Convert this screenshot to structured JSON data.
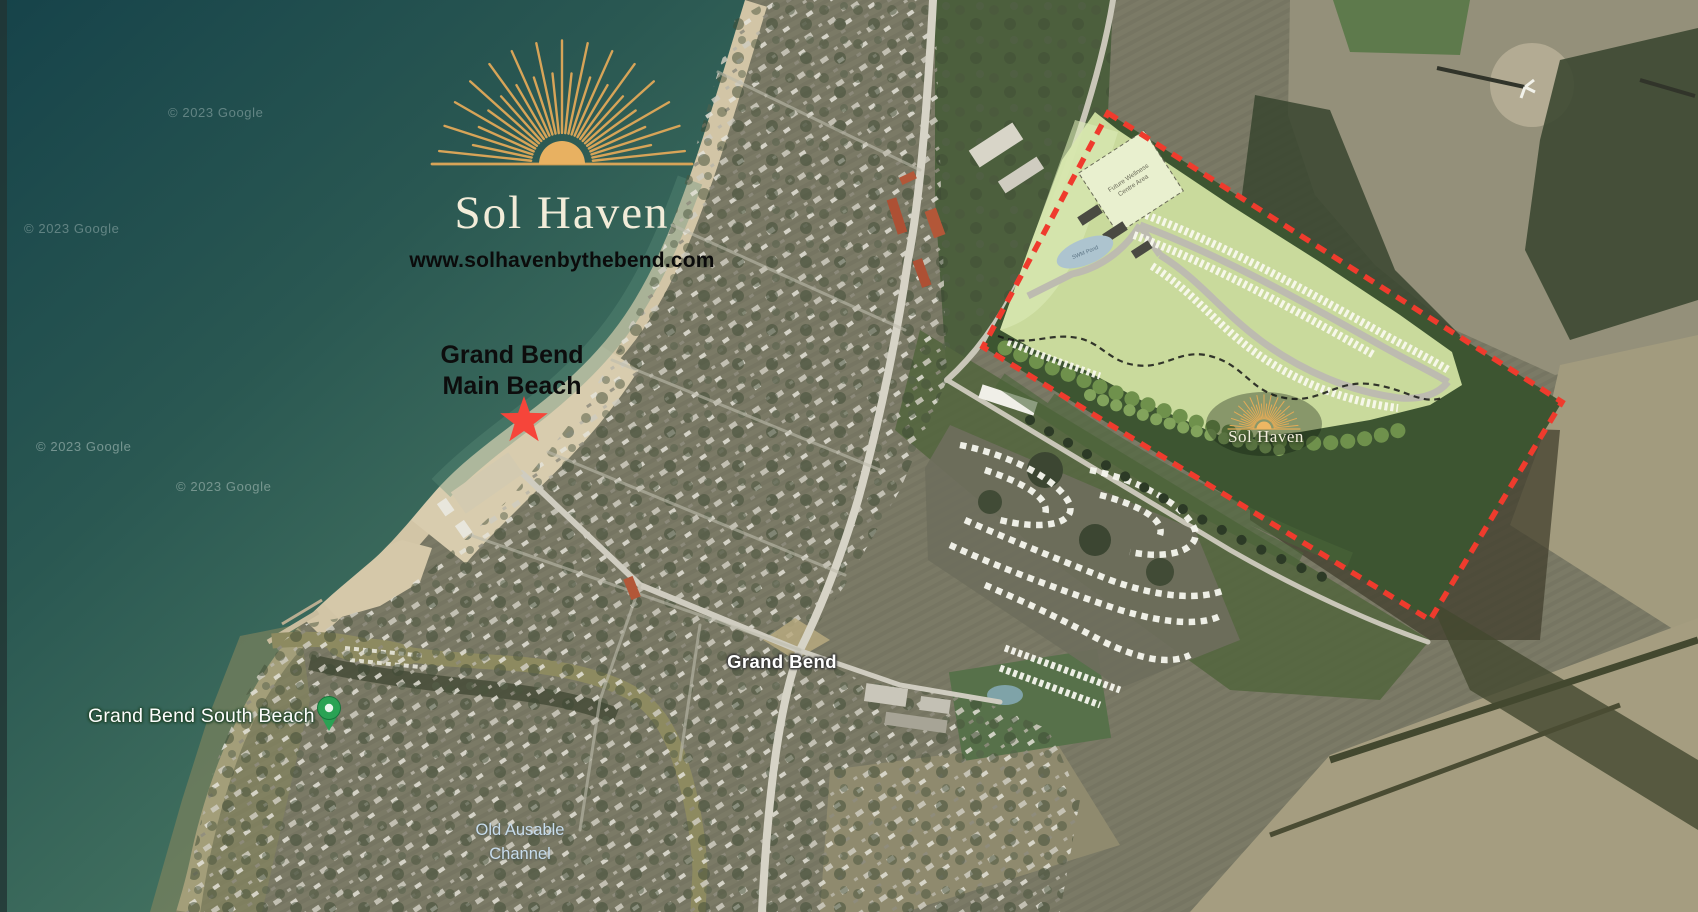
{
  "branding": {
    "logo_title": "Sol Haven",
    "website": "www.solhavenbythebend.com",
    "site_plan_logo": "Sol Haven"
  },
  "map_labels": {
    "main_beach_line1": "Grand Bend",
    "main_beach_line2": "Main Beach",
    "town": "Grand Bend",
    "south_beach": "Grand Bend South Beach",
    "channel_line1": "Old Ausable",
    "channel_line2": "Channel"
  },
  "site_plan": {
    "future_area_line1": "Future Wellness",
    "future_area_line2": "Centre Area",
    "pond_label": "SWM Pond"
  },
  "watermark": {
    "text": "© 2023 Google"
  },
  "icons": {
    "logo_mark": "sunrise-rays-icon",
    "main_beach_marker": "red-star-icon",
    "south_beach_marker": "green-map-pin-icon"
  },
  "colors": {
    "boundary_red": "#ef3b2d",
    "star_red": "#f6453a",
    "pin_green": "#2aa254",
    "logo_gold": "#d7a458",
    "logo_cream": "#f2ecd9",
    "plan_green": "#cfe0a0",
    "water_teal": "#16434a"
  }
}
